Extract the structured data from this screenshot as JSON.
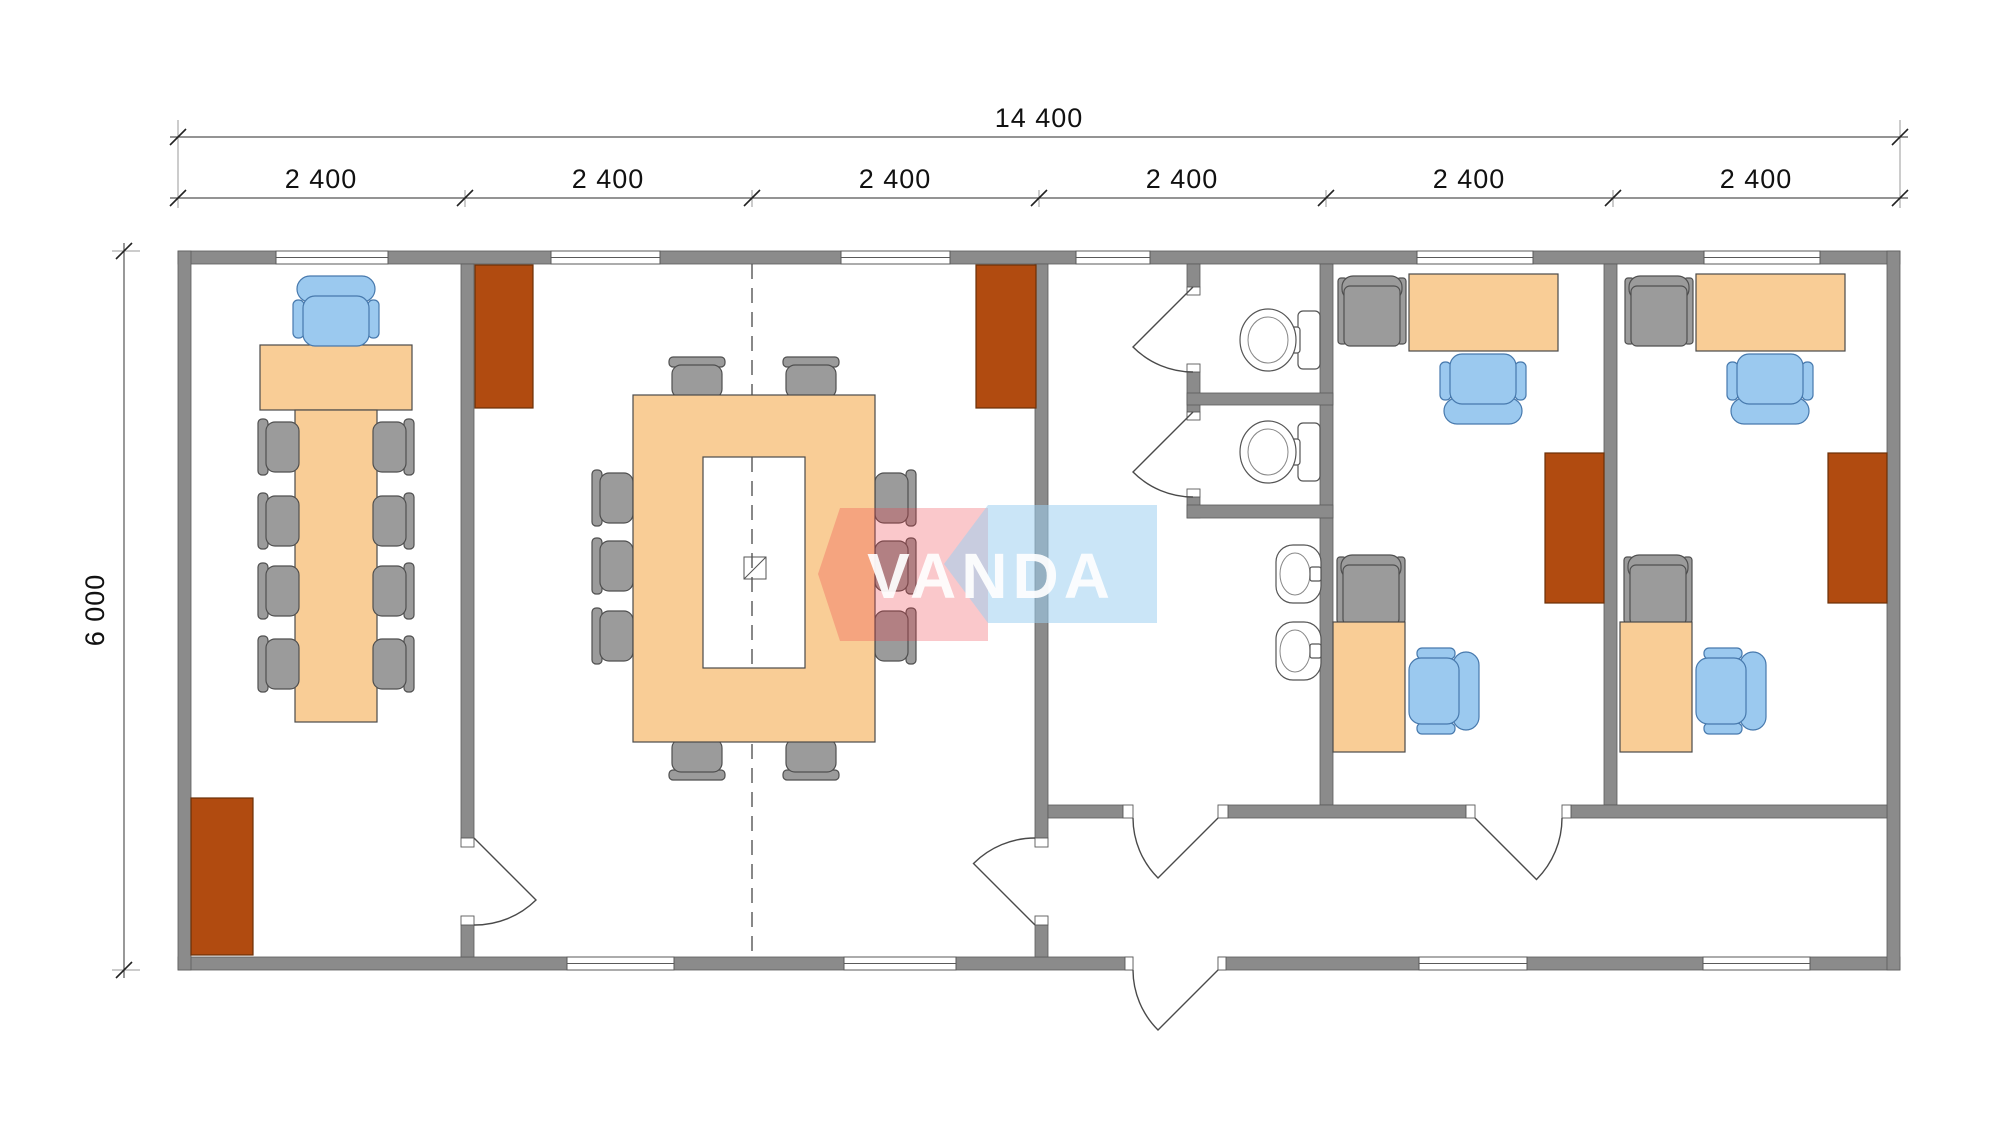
{
  "plan": {
    "dimensions": {
      "total_width_label": "14 400",
      "module_labels": [
        "2 400",
        "2 400",
        "2 400",
        "2 400",
        "2 400",
        "2 400"
      ],
      "total_height_label": "6 000"
    },
    "watermark": {
      "text": "VANDA"
    },
    "colors": {
      "wall": "#8b8b8b",
      "wall_stroke": "#5a5a5a",
      "desk": "#f9cd96",
      "desk_stroke": "#4a4a4a",
      "radiator": "#b14b10",
      "radiator_stroke": "#6b3008",
      "chair_gray": "#9b9b9b",
      "chair_gray_stroke": "#4f4f4f",
      "chair_blue": "#9bc9ef",
      "chair_blue_stroke": "#4779ad",
      "dash": "#555555",
      "watermark_pink": "#ee3b46",
      "watermark_blue": "#9fd0f0",
      "watermark_text": "#ffffff"
    },
    "rooms": [
      {
        "name": "meeting-office",
        "furniture": [
          "head-desk",
          "long-table",
          "1 blue office chair",
          "8 gray chairs",
          "1 radiator"
        ]
      },
      {
        "name": "conference-room",
        "furniture": [
          "ring-conference-table",
          "10 gray chairs",
          "2 radiators",
          "column"
        ]
      },
      {
        "name": "wc-block",
        "furniture": [
          "2 toilets",
          "2 sinks",
          "2 stall doors"
        ]
      },
      {
        "name": "office-a",
        "furniture": [
          "desk",
          "blue office chair",
          "2 gray cabinets",
          "side desk",
          "blue chair",
          "radiator"
        ]
      },
      {
        "name": "office-b",
        "furniture": [
          "desk",
          "blue office chair",
          "2 gray cabinets",
          "side desk",
          "blue chair",
          "radiator"
        ]
      },
      {
        "name": "corridor",
        "furniture": [
          "entrance-door"
        ]
      }
    ]
  }
}
